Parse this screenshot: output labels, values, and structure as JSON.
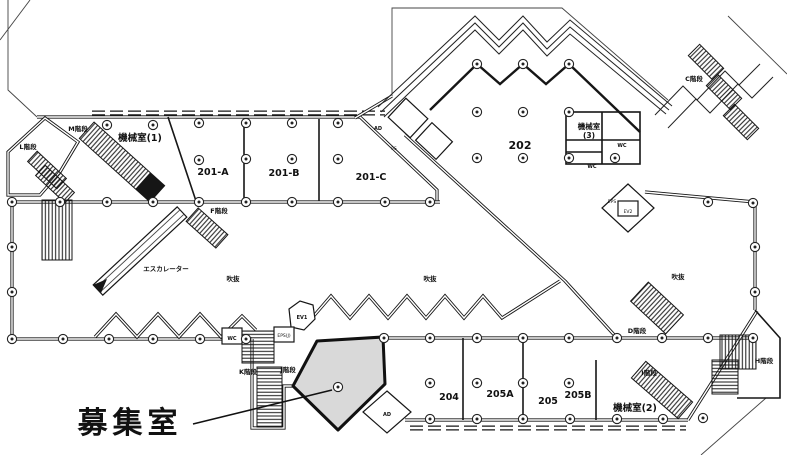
{
  "plan": {
    "rooms": {
      "machine1": "機械室(1)",
      "r201a": "201-A",
      "r201b": "201-B",
      "r201c": "201-C",
      "r202": "202",
      "machine3_line1": "機械室",
      "machine3_line2": "(3)",
      "r204": "204",
      "r205a": "205A",
      "r205": "205",
      "r205b": "205B",
      "machine2": "機械室(2)"
    },
    "stairs": {
      "c": "C階段",
      "d": "D階段",
      "f": "F階段",
      "h": "H階段",
      "i": "I階段",
      "j": "J階段",
      "k": "K階段",
      "l": "L階段",
      "m": "M階段"
    },
    "features": {
      "escalator": "エスカレーター",
      "atrium": "吹抜",
      "wc": "WC",
      "ev1": "EV1",
      "ev2": "EV2",
      "eps": "EPS",
      "eps_j": "EPS(J)",
      "ad": "AD",
      "ps": "PS"
    },
    "highlight": {
      "label": "募集室",
      "fill_color": "#d9d9d9"
    },
    "colors": {
      "line": "#161616",
      "background": "#ffffff"
    }
  }
}
